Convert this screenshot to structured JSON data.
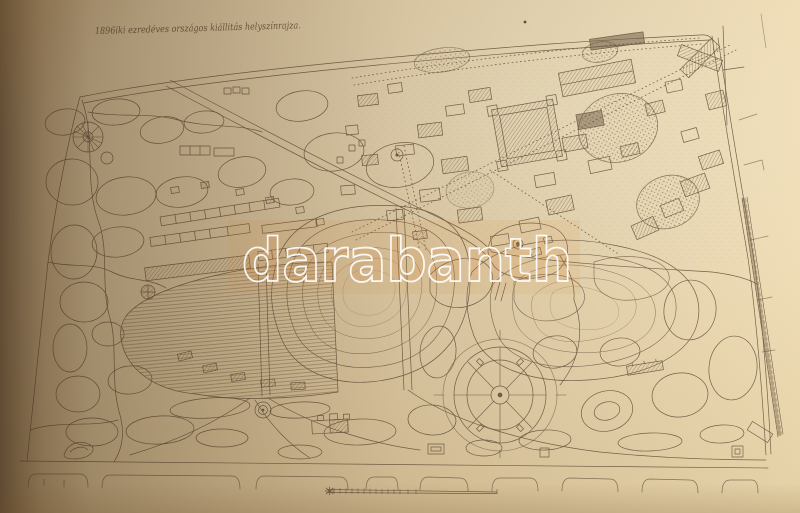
{
  "photo": {
    "kind": "photograph-of-engraved-map-sheet",
    "paper_color": "#eedcb5",
    "ink_color": "#6a5843",
    "corner_shadow_color": "#1c120a"
  },
  "map": {
    "handwritten_title": "1896iki ezredéves országos kiállitás helyszínrajza.",
    "features": {
      "exhibition_district": "hatched exhibition halls and pavilions",
      "drained_lake": "lake bed with contour hatching",
      "island_group": "contoured island with buildings",
      "rondo_garden": "circular parterre with radial paths",
      "park_paths": "organic park path network",
      "boundary_roads": "perimeter roads and railway line",
      "scale_bar": "graphic scale bar (unlabelled)"
    }
  },
  "watermark": {
    "text": "darabanth",
    "outline_color": "#ffffff"
  }
}
